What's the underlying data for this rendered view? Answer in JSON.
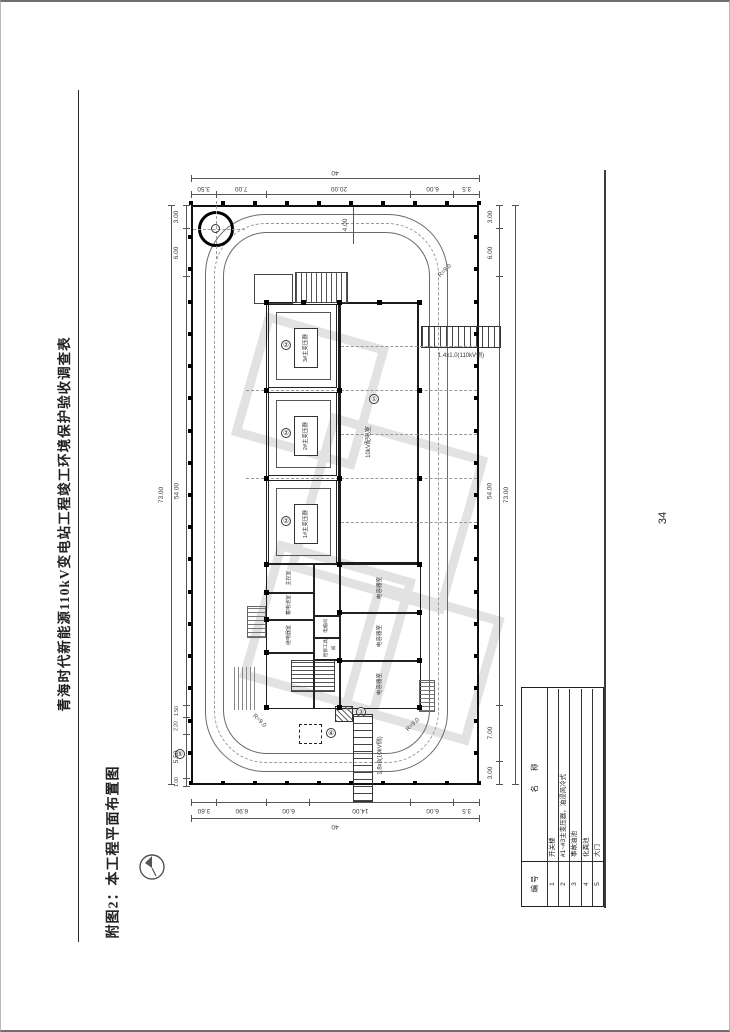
{
  "page": {
    "number": "34"
  },
  "header": {
    "title": "青海时代新能源110kV变电站工程竣工环境保护验收调查表"
  },
  "caption": {
    "text": "附图2：本工程平面布置图"
  },
  "drawing": {
    "dims": {
      "top": {
        "total": "40",
        "segments": [
          "3.50",
          "7.00",
          "20.00",
          "6.00",
          "3.5"
        ]
      },
      "bottom": {
        "total": "40",
        "segments": [
          "3.60",
          "6.90",
          "6.00",
          "14.00",
          "6.00",
          "3.5"
        ]
      },
      "left": {
        "total": "73.00",
        "segments": [
          "3.00",
          "6.00",
          "54.00",
          "1.50",
          "2.20",
          "5.50",
          "1.00"
        ]
      },
      "right": {
        "total": "73.00",
        "segments": [
          "3.00",
          "6.00",
          "54.00",
          "7.00",
          "3.00"
        ]
      },
      "road_offset": "4.00",
      "corner_radius": "R=9.0"
    },
    "buildings": {
      "hall_label": "10kV配电室",
      "hall_marker": "①",
      "transformer_bays": [
        {
          "label": "3#主变压器",
          "marker": "②"
        },
        {
          "label": "2#主变压器",
          "marker": "②"
        },
        {
          "label": "1#主变压器",
          "marker": "②"
        }
      ],
      "capacitor_rooms": [
        "电容器室",
        "电容器室",
        "电容器室"
      ],
      "left_rooms": [
        "主控室",
        "蓄电池室",
        "继电器室"
      ],
      "small_rooms": [
        "电缆间",
        "检修工具间"
      ]
    },
    "gates": {
      "right_label": "1.4x1.0(110kV侧)",
      "bottom_label": "1.8x8(10kV侧)"
    },
    "markers": {
      "oil_pool": "③",
      "septic_tank": "④",
      "gate": "⑤"
    },
    "legend": {
      "headers": [
        "编 号",
        "名 称"
      ],
      "rows": [
        {
          "no": "1",
          "name": "开关楼"
        },
        {
          "no": "2",
          "name": "#1~#3主变压器，油浸风冷式"
        },
        {
          "no": "3",
          "name": "事故油池"
        },
        {
          "no": "4",
          "name": "化粪池"
        },
        {
          "no": "5",
          "name": "大门"
        }
      ]
    }
  }
}
